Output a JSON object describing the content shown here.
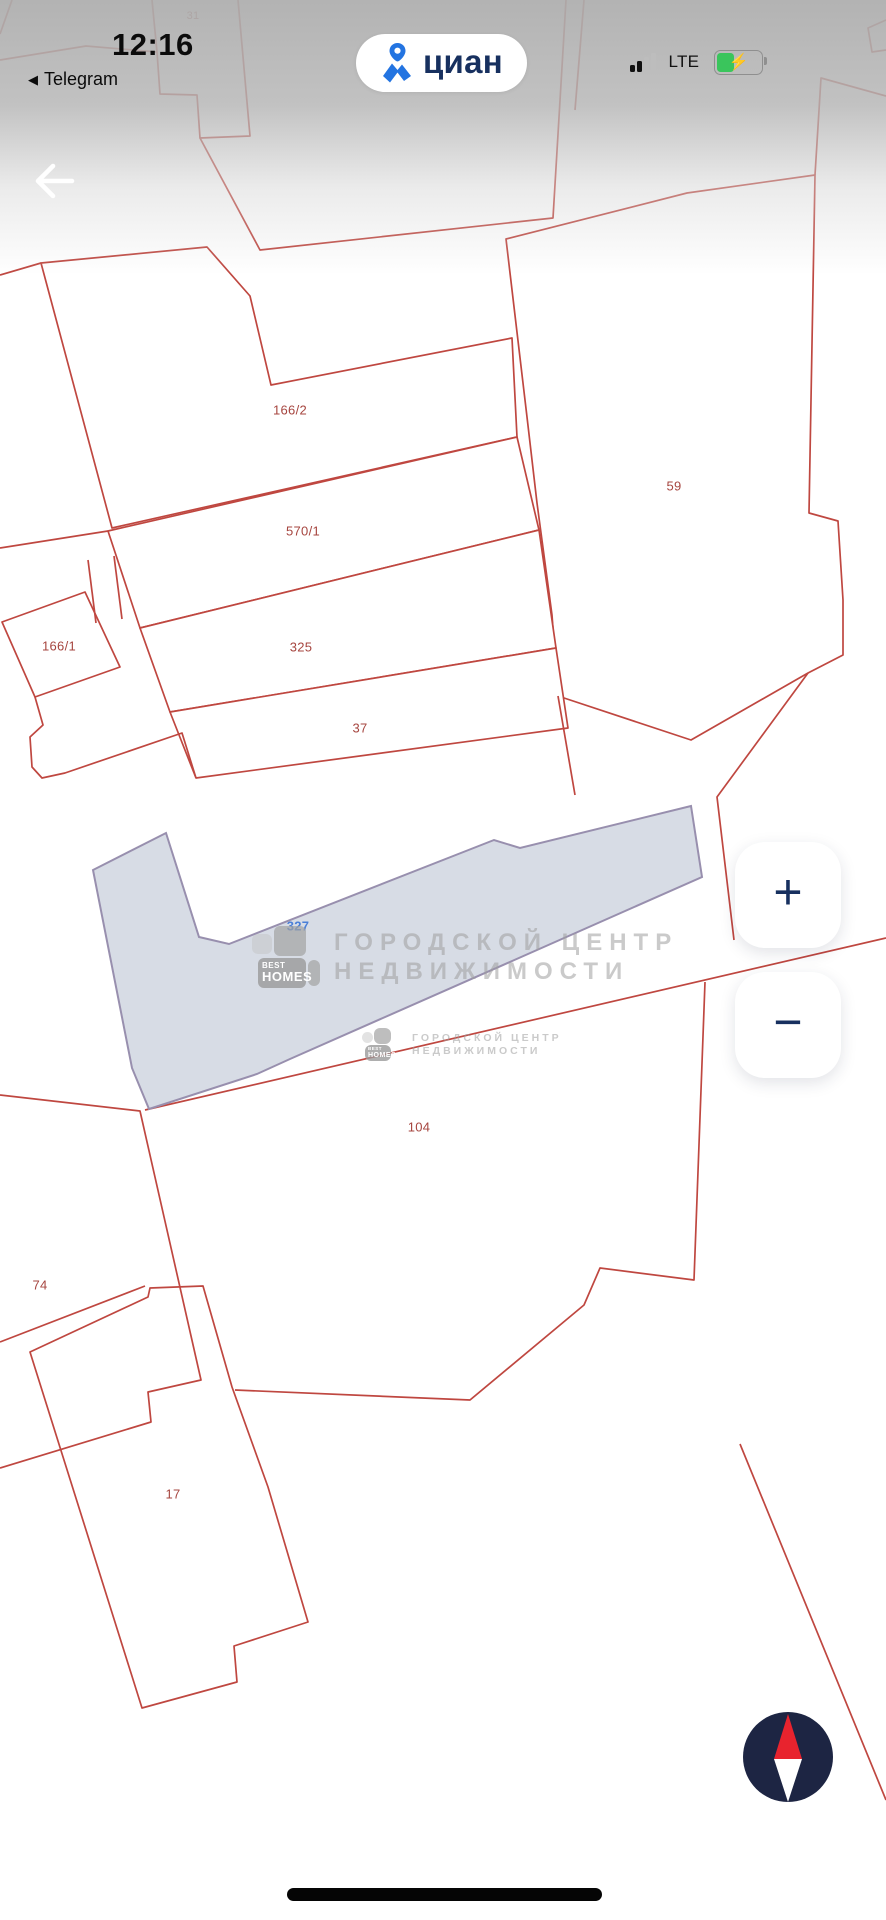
{
  "status_bar": {
    "time": "12:16",
    "back_arrow_glyph": "◀",
    "back_to_app": "Telegram",
    "app_badge": "циан",
    "network": "LTE"
  },
  "map": {
    "parcel_labels": [
      {
        "text": "31",
        "x": 193,
        "y": 16,
        "style": "red small"
      },
      {
        "text": "166/2",
        "x": 290,
        "y": 410,
        "style": "red"
      },
      {
        "text": "570/1",
        "x": 303,
        "y": 531,
        "style": "red"
      },
      {
        "text": "59",
        "x": 674,
        "y": 486,
        "style": "red"
      },
      {
        "text": "166/1",
        "x": 59,
        "y": 646,
        "style": "red"
      },
      {
        "text": "325",
        "x": 301,
        "y": 647,
        "style": "red"
      },
      {
        "text": "37",
        "x": 360,
        "y": 728,
        "style": "red"
      },
      {
        "text": "327",
        "x": 298,
        "y": 926,
        "style": "blue"
      },
      {
        "text": "104",
        "x": 419,
        "y": 1127,
        "style": "red"
      },
      {
        "text": "74",
        "x": 40,
        "y": 1285,
        "style": "red"
      },
      {
        "text": "17",
        "x": 173,
        "y": 1494,
        "style": "red"
      }
    ]
  },
  "watermarks": {
    "brand_line1": "BEST",
    "brand_line2": "HOMES",
    "text_line1": "ГОРОДСКОЙ ЦЕНТР",
    "text_line2": "НЕДВИЖИМОСТИ"
  },
  "zoom_controls": {
    "zoom_in": "+",
    "zoom_out": "−"
  },
  "battery": {
    "charging_glyph": "⚡"
  },
  "colors": {
    "parcel_line": "#bf4740",
    "parcel_label": "#a6453f",
    "selected_label": "#4a7fd7",
    "selected_fill": "#d4d9e3",
    "selected_stroke": "#988fae",
    "logo_blue": "#2374e1",
    "navy": "#17305f",
    "compass_navy": "#1d2543",
    "compass_red": "#e8232e"
  }
}
